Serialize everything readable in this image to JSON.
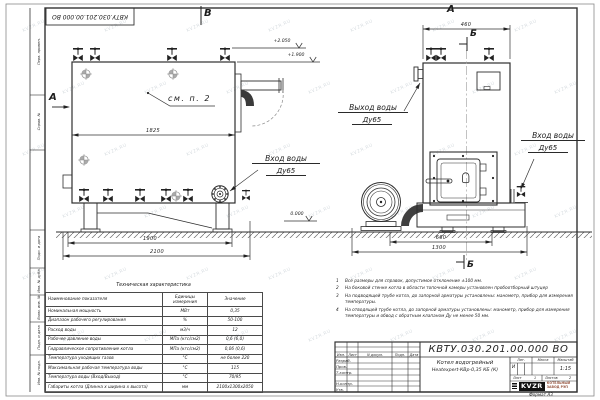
{
  "watermark": {
    "text": "KVZR.RU"
  },
  "stamp_top": "КВТУ.030.201.00.000 ВО",
  "margin_labels": [
    "Перв. примен.",
    "Справ. №",
    "Подп. и дата",
    "Инв. № дубл.",
    "Взам. инв. №",
    "Подп. и дата",
    "Инв. № подл."
  ],
  "views": {
    "front_label": "А",
    "side_arrow_label": "А",
    "side_label": "В",
    "section_label_top": "Б",
    "section_label_bottom": "Б"
  },
  "levels": {
    "top": "+2.050",
    "body": "+1.900",
    "ground": "0.000"
  },
  "dims": {
    "side_body_length": "1825",
    "side_skid_length": "1900",
    "side_overall_length": "2100",
    "front_width": "460",
    "front_base": "660",
    "front_overall": "1300"
  },
  "callouts": {
    "see_note": "см. п. 2",
    "inlet_side": {
      "line1": "Вход воды",
      "line2": "Ду65"
    },
    "outlet_front": {
      "line1": "Выход воды",
      "line2": "Ду65"
    },
    "inlet_front": {
      "line1": "Вход воды",
      "line2": "Ду65"
    }
  },
  "notes": [
    {
      "n": "1",
      "text": "Все размеры для справок, допустимое отклонение ±100 мм."
    },
    {
      "n": "2",
      "text": "На боковой стенке котла в области топочной камеры установлен пробоотборный штуцер"
    },
    {
      "n": "3",
      "text": "На подводящей трубе котла, до запорной арматуры установлены: манометр, прибор для измерения температуры."
    },
    {
      "n": "4",
      "text": "На отводящей трубе котла, до запорной арматуры установлены: манометр, прибор для измерения температуры и обвод с обратным клапаном Ду не менее 50 мм."
    }
  ],
  "tech_table": {
    "title": "Техническая характеристика",
    "headers": [
      "Наименование показателя",
      "Единицы измерения",
      "Значение"
    ],
    "rows": [
      [
        "Номинальная мощность",
        "МВт",
        "0,35"
      ],
      [
        "Диапазон рабочего регулирования",
        "%",
        "50-100"
      ],
      [
        "Расход воды",
        "м3/ч",
        "12"
      ],
      [
        "Рабочее давление воды",
        "МПа (кгс/см2)",
        "0,6 (6,0)"
      ],
      [
        "Гидравлическое сопротивление котла",
        "МПа (кгс/см2)",
        "0,06 (0,6)"
      ],
      [
        "Температура уходящих газов",
        "°С",
        "не более 220"
      ],
      [
        "Максимальная рабочая температура воды",
        "°С",
        "115"
      ],
      [
        "Температура воды (Вход/Выход)",
        "°С",
        "70/95"
      ],
      [
        "Габариты котла (Длинна х ширина х высота)",
        "мм",
        "2100х1300х2050"
      ]
    ]
  },
  "title_block": {
    "doc_code": "КВТУ.030.201.00.000 ВО",
    "rev_headers": [
      "Изм.",
      "Лист",
      "N докум.",
      "Подп.",
      "Дата"
    ],
    "roles": [
      "Разраб.",
      "Пров.",
      "Т.контр.",
      "Н.контр.",
      "Утв."
    ],
    "product_line1": "Котел водогрейный",
    "product_line2": "Heatexpert-КВр-0,35 КБ (К)",
    "lit_label": "Лит.",
    "lit_value": "И",
    "mass_label": "Масса",
    "scale_label": "Масштаб",
    "scale_value": "1:15",
    "sheet_label": "Лист",
    "sheet_value": "1",
    "sheets_label": "Листов",
    "sheets_value": "2",
    "logo_text": "KVZR",
    "company_line1": "КОТЕЛЬНЫЙ",
    "company_line2": "ЗАВОД РЭП",
    "format_label": "Формат А3"
  }
}
